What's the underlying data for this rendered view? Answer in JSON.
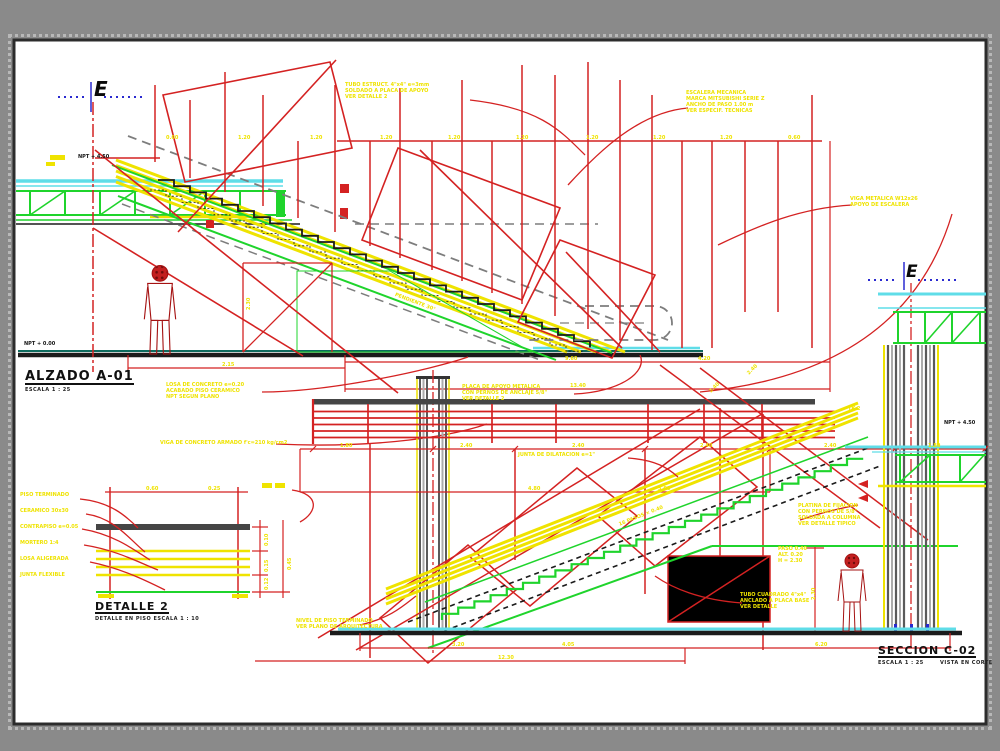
{
  "colors": {
    "bg": "#8a8a8a",
    "sheet": "#ffffff",
    "border": "#2c2c2c",
    "red": "#d42222",
    "yellow": "#efe300",
    "green": "#1fd42c",
    "cyan": "#5fdde8",
    "teal": "#0e6b5e",
    "blue_fill": "#2a55d6",
    "blue_dot": "#1d3fa8",
    "blue_marker": "#2a2ad0",
    "dark": "#1b1b1b",
    "gray": "#7d7d7d",
    "bar": "#454545",
    "col_dark": "#5a5a5a",
    "col_light": "#ababab",
    "person": "#c32020",
    "person_dark": "#700c0c"
  },
  "titles": {
    "alzado": {
      "label": "ALZADO A-01",
      "sub": "ESCALA  1 : 25"
    },
    "detalle": {
      "label": "DETALLE 2",
      "sub": "DETALLE EN PISO   ESCALA  1 : 10"
    },
    "seccion": {
      "label": "SECCION C-02",
      "sub": "ESCALA  1 : 25",
      "sub2": "VISTA EN CORTE"
    }
  },
  "markers": {
    "e": "E",
    "npt_upper": "NPT + 4.50",
    "npt_lower": "NPT + 0.00",
    "npt_right": "NPT + 4.50"
  },
  "annotations": {
    "c1": [
      "TUBO ESTRUCT. 4\"x4\" e=3mm",
      "SOLDADO A PLACA DE APOYO",
      "VER DETALLE 2"
    ],
    "c2": [
      "ESCALERA MECANICA",
      "MARCA MITSUBISHI SERIE Z",
      "ANCHO DE PASO 1.00 m",
      "VER ESPECIF. TECNICAS"
    ],
    "c3": [
      "VIGA METALICA W12x26",
      "APOYO DE ESCALERA"
    ],
    "c4": [
      "PLACA DE APOYO METALICA",
      "CON PERNOS DE ANCLAJE 5/8\"",
      "VER DETALLE 2"
    ],
    "c5": [
      "VIGA DE CONCRETO ARMADO f'c=210 kg/cm2"
    ],
    "c6": [
      "LOSA DE CONCRETO e=0.20",
      "ACABADO PISO CERAMICO",
      "NPT SEGUN PLANO"
    ],
    "c8": [
      "NIVEL DE PISO TERMINADO",
      "VER PLANO DE ARQUITECTURA"
    ],
    "c9": [
      "TUBO CUADRADO 4\"x4\"",
      "ANCLADO A PLACA BASE",
      "VER DETALLE"
    ],
    "c10": [
      "PLATINA DE FIJACION",
      "CON PERNOS DE 5/8\"",
      "SOLDADA A COLUMNA",
      "VER DETALLE TIPICO"
    ],
    "c11": [
      "PASO 0.40",
      "ALT. 0.20",
      "H = 2.30"
    ],
    "c12": [
      "JUNTA DE DILATACION e=1\""
    ],
    "detalle_left": [
      "PISO TERMINADO",
      "CERAMICO 30x30",
      "CONTRAPISO e=0.05",
      "MORTERO 1:4",
      "LOSA ALIGERADA",
      "JUNTA FLEXIBLE"
    ]
  },
  "dims": {
    "top_row": [
      "0.60",
      "1.20",
      "1.20",
      "1.20",
      "1.20",
      "1.20",
      "1.20",
      "1.20",
      "1.20",
      "0.60"
    ],
    "alzado_ground": [
      "2.15",
      "9.60",
      "13.40",
      "4.20"
    ],
    "person1_height": "2.30",
    "person2_height": "2.30",
    "beam_row": [
      "1.80",
      "2.40",
      "2.40",
      "2.40",
      "2.40",
      "1.80"
    ],
    "beam_row2": [
      "4.80",
      "3.60"
    ],
    "seccion_bottom": [
      "3.20",
      "4.05",
      "6.20",
      "12.30"
    ],
    "detalle_top": [
      "0.60",
      "0.25"
    ],
    "detalle_right": [
      "0.10",
      "0.15",
      "0.12",
      "0.45"
    ],
    "slope_label": "PENDIENTE 30°",
    "steps_label": "16 PASOS × 0.40",
    "tk_label": "TK-2",
    "diag_a": "2.40",
    "diag_b": "2.40"
  }
}
